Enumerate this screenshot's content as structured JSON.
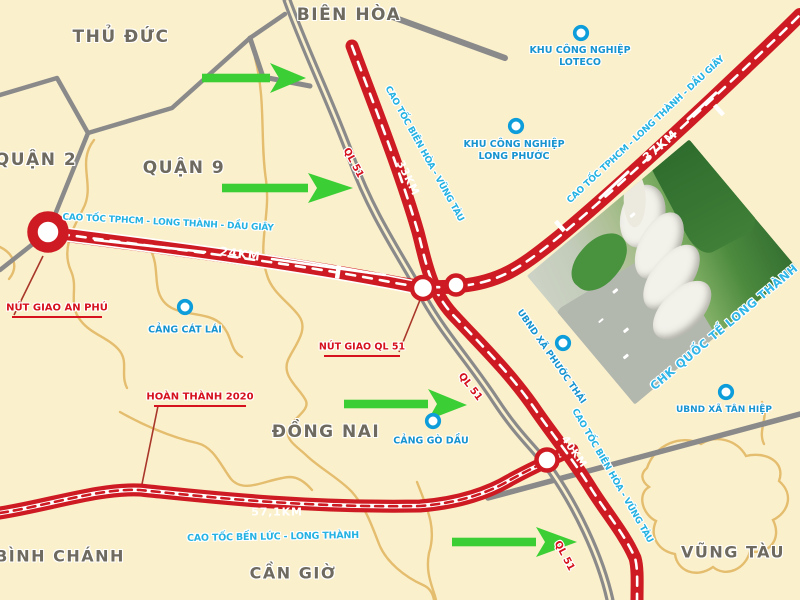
{
  "map": {
    "regions": {
      "thu_duc": "THỦ ĐỨC",
      "bien_hoa": "BIÊN HÒA",
      "quan_2": "QUẬN 2",
      "quan_9": "QUẬN 9",
      "dong_nai": "ĐỒNG NAI",
      "binh_chanh": "BÌNH CHÁNH",
      "can_gio": "CẦN GIỜ",
      "vung_tau": "VŨNG TÀU"
    },
    "roads": {
      "cao_toc_tphcm": "CAO TỐC TPHCM - LONG THÀNH - DẦU GIÂY",
      "cao_toc_bien_hoa": "CAO TỐC BIÊN HÒA - VŨNG TÀU",
      "cao_toc_ben_luc": "CAO TỐC BẾN LỨC - LONG THÀNH",
      "ql51": "QL 51"
    },
    "distances": {
      "d24": "24KM",
      "d33": "33KM",
      "d37": "37KM",
      "d40": "40KM",
      "d571": "57,1KM"
    },
    "junctions": {
      "an_phu": "NÚT GIAO AN PHÚ",
      "ql51": "NÚT GIAO QL 51"
    },
    "note": {
      "hoan_thanh": "HOÀN THÀNH 2020"
    },
    "pois": {
      "kcn": "KHU CÔNG NGHIỆP",
      "loteco": "LOTECO",
      "long_phuoc": "LONG PHƯỚC",
      "cang_cat_lai": "CẢNG CÁT LÁI",
      "cang_go_dau": "CẢNG GÒ DẦU",
      "ubnd_phuoc_thai": "UBND XÃ PHƯỚC THÁI",
      "ubnd_tan_hiep": "UBND XÃ TÂN HIỆP",
      "chk_long_thanh": "CHK QUỐC TẾ LONG THÀNH"
    },
    "colors": {
      "background": "#fbf0cc",
      "expressway_red": "#ce1b23",
      "road_gray": "#8a8a8a",
      "minor_road_tan": "#e4bd6e",
      "poi_label_blue": "#1794cf",
      "road_label_cyan": "#25b2e2",
      "red_label": "#d5121e",
      "region_label_gray": "#6e6a60",
      "arrow_green": "#3ccf35",
      "marker_blue": "#0d9ddb"
    }
  }
}
